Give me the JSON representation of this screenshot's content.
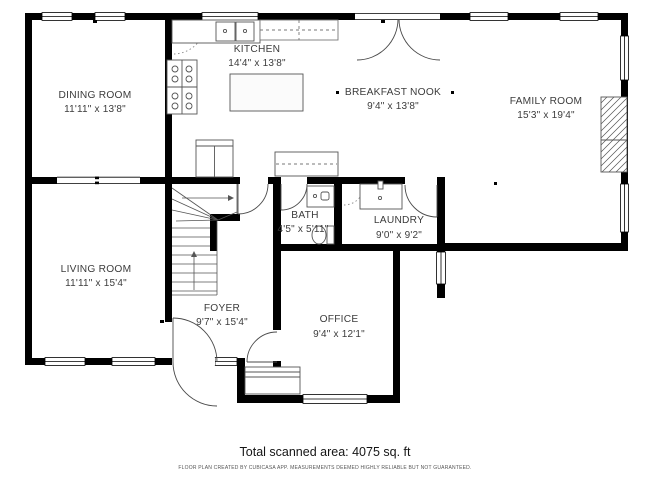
{
  "rooms": {
    "dining": {
      "name": "DINING ROOM",
      "dims": "11'11\" x 13'8\""
    },
    "kitchen": {
      "name": "KITCHEN",
      "dims": "14'4\" x 13'8\""
    },
    "breakfast": {
      "name": "BREAKFAST NOOK",
      "dims": "9'4\" x 13'8\""
    },
    "family": {
      "name": "FAMILY ROOM",
      "dims": "15'3\" x 19'4\""
    },
    "living": {
      "name": "LIVING ROOM",
      "dims": "11'11\" x 15'4\""
    },
    "foyer": {
      "name": "FOYER",
      "dims": "9'7\" x 15'4\""
    },
    "bath": {
      "name": "BATH",
      "dims": "4'5\" x 5'11\""
    },
    "laundry": {
      "name": "LAUNDRY",
      "dims": "9'0\" x 9'2\""
    },
    "office": {
      "name": "OFFICE",
      "dims": "9'4\" x 12'1\""
    }
  },
  "footer": {
    "total_area": "Total scanned area: 4075 sq. ft",
    "disclaimer": "FLOOR PLAN CREATED BY CUBICASA APP. MEASUREMENTS DEEMED HIGHLY RELIABLE BUT NOT GUARANTEED."
  },
  "colors": {
    "wall": "#000000",
    "fixture_line": "#555555",
    "text": "#3c3c3c"
  }
}
